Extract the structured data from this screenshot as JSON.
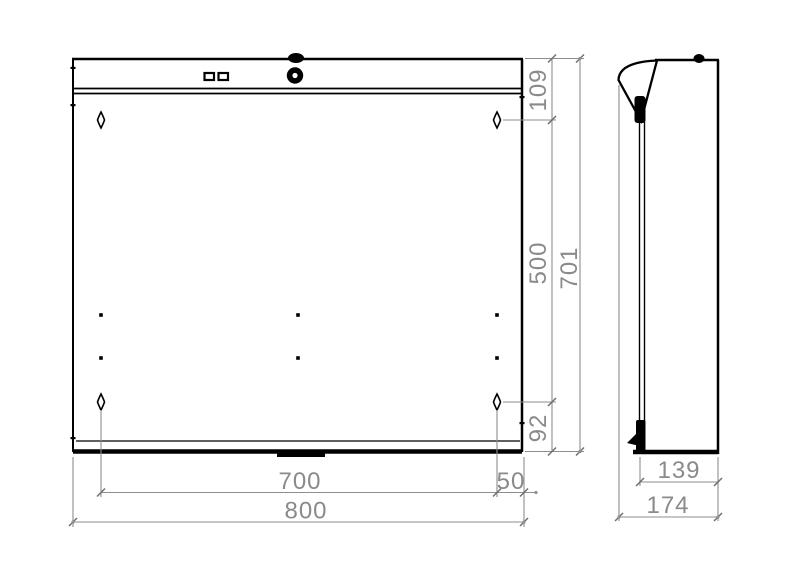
{
  "drawing": {
    "title": "enclosure-technical-drawing",
    "colors": {
      "outline": "#000000",
      "dimension_line": "#8e8e8e",
      "dimension_text": "#8a8a8a",
      "background": "#ffffff"
    },
    "views": {
      "front": {
        "name": "front-view",
        "dimensions": {
          "top_to_hole": "109",
          "hole_span_vertical": "500",
          "overall_height": "701",
          "hole_to_bottom": "92",
          "hole_span_horizontal": "700",
          "hole_to_edge": "50",
          "overall_width": "800"
        }
      },
      "side": {
        "name": "side-view",
        "dimensions": {
          "body_depth": "139",
          "overall_depth": "174"
        }
      }
    }
  }
}
